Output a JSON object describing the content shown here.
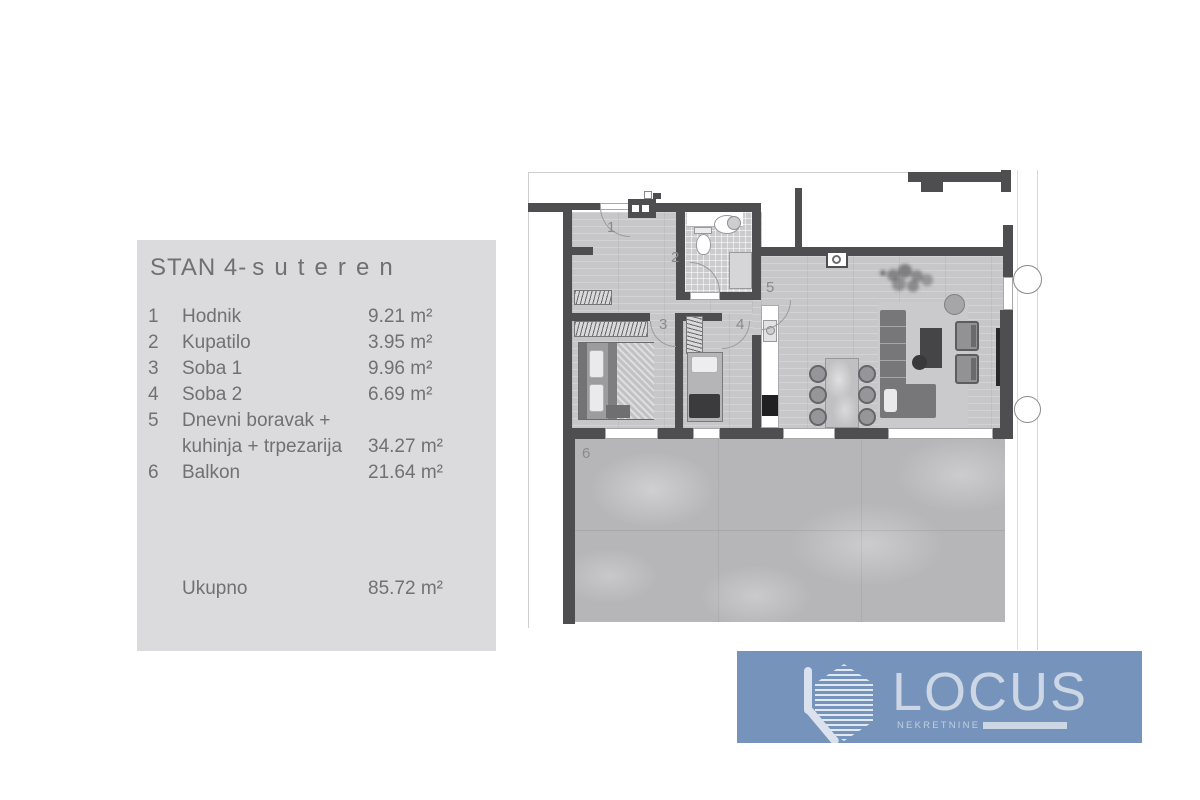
{
  "panel": {
    "title_main": "STAN 4-",
    "title_spaced": "suteren",
    "rooms": [
      {
        "num": "1",
        "name": "Hodnik",
        "area": "9.21 m²"
      },
      {
        "num": "2",
        "name": "Kupatilo",
        "area": "3.95 m²"
      },
      {
        "num": "3",
        "name": "Soba 1",
        "area": "9.96 m²"
      },
      {
        "num": "4",
        "name": "Soba 2",
        "area": "6.69 m²"
      },
      {
        "num": "5",
        "name": "Dnevni boravak + kuhinja + trpezarija",
        "area": "34.27 m²"
      },
      {
        "num": "6",
        "name": "Balkon",
        "area": "21.64 m²"
      }
    ],
    "total": {
      "label": "Ukupno",
      "area": "85.72 m²"
    }
  },
  "logo": {
    "brand": "LOCUS",
    "subtitle": "NEKRETNINE"
  },
  "colors": {
    "panel_bg": "#dbdbdd",
    "panel_text": "#717174",
    "wall": "#4e4e50",
    "logo_bg": "#7593bb",
    "logo_text": "#ccd6e4"
  }
}
